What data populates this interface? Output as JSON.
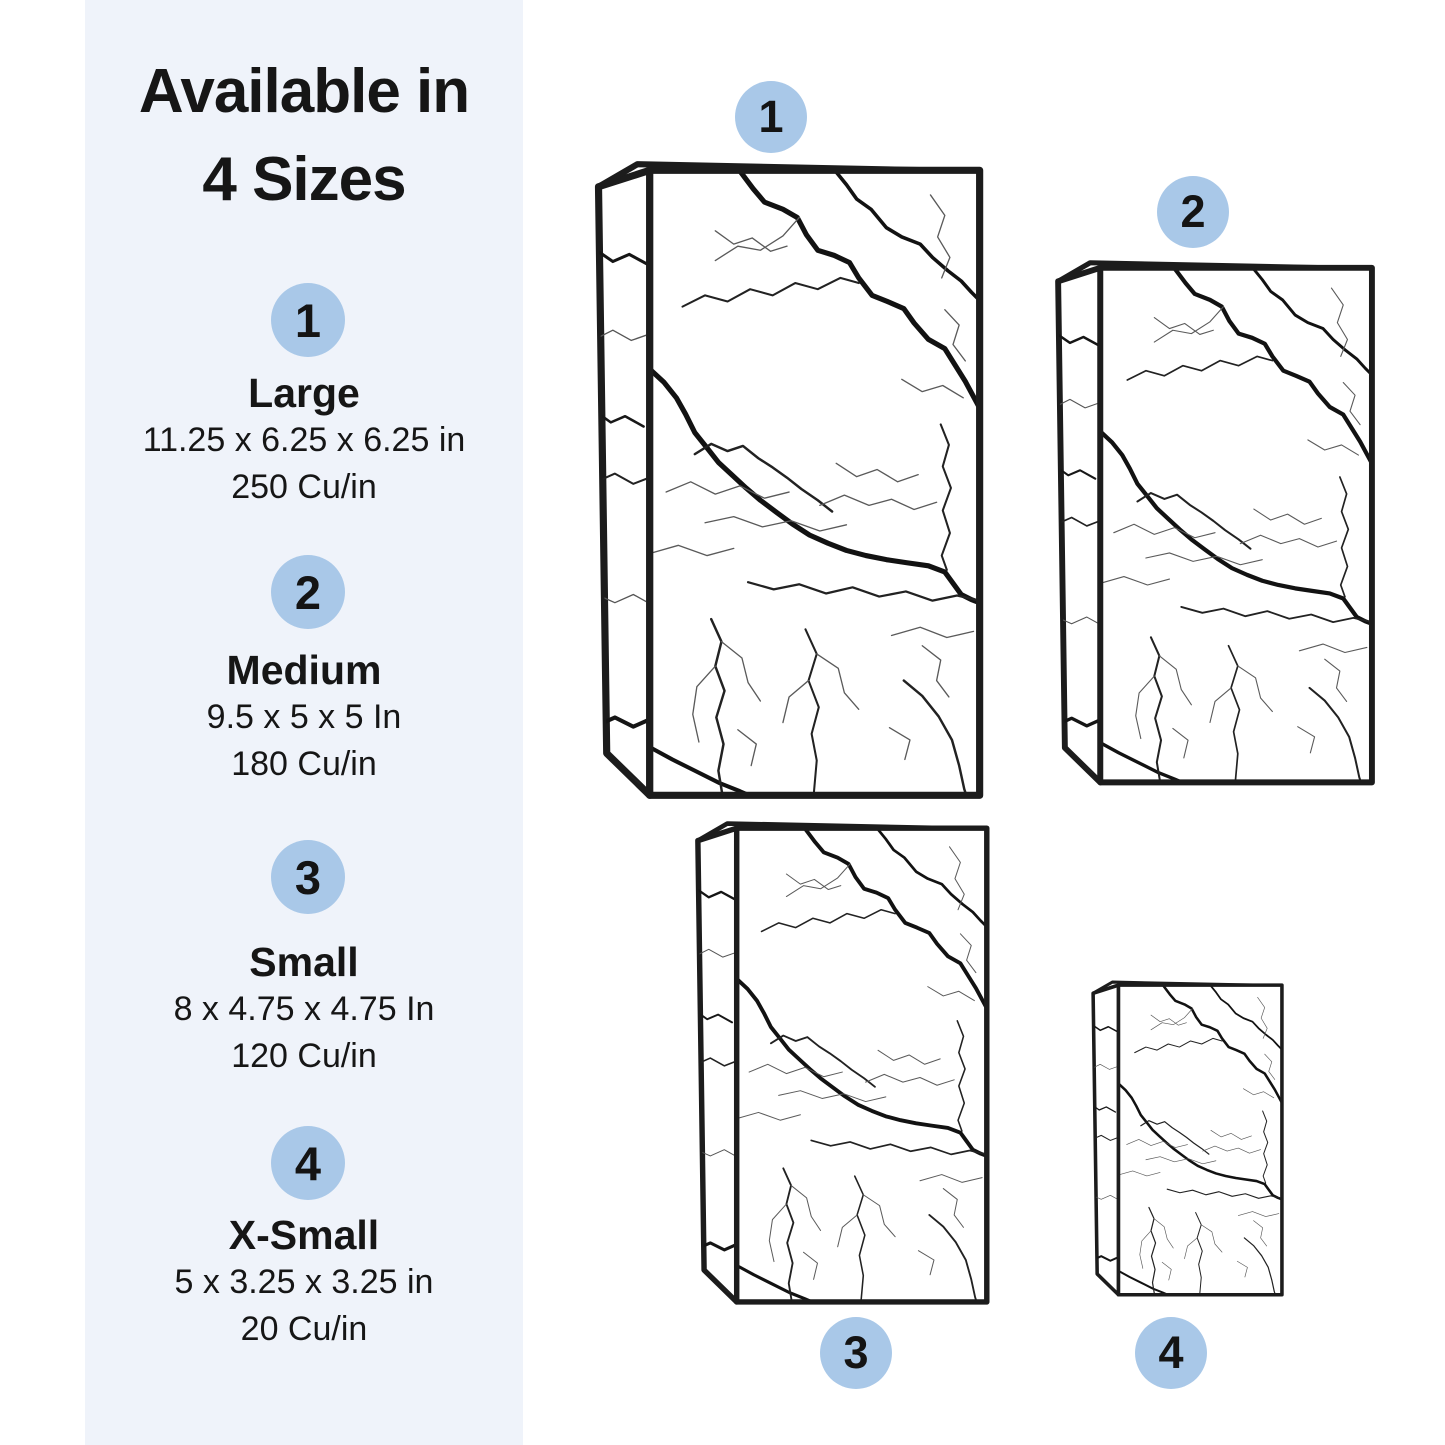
{
  "colors": {
    "page_bg": "#ffffff",
    "panel_bg": "#eff3fa",
    "badge_bg": "#a9c8e8",
    "ink": "#161616"
  },
  "sidebar": {
    "title_line1": "Available in",
    "title_line2": "4 Sizes",
    "sizes": [
      {
        "number": "1",
        "name": "Large",
        "dimensions": "11.25 x 6.25 x 6.25 in",
        "volume": "250 Cu/in"
      },
      {
        "number": "2",
        "name": "Medium",
        "dimensions": "9.5 x 5 x 5 In",
        "volume": "180 Cu/in"
      },
      {
        "number": "3",
        "name": "Small",
        "dimensions": "8 x 4.75 x 4.75 In",
        "volume": "120 Cu/in"
      },
      {
        "number": "4",
        "name": "X-Small",
        "dimensions": "5 x 3.25 x 3.25 in",
        "volume": "20 Cu/in"
      }
    ]
  },
  "diagram": {
    "boxes": [
      {
        "number": "1",
        "size_name": "Large"
      },
      {
        "number": "2",
        "size_name": "Medium"
      },
      {
        "number": "3",
        "size_name": "Small"
      },
      {
        "number": "4",
        "size_name": "X-Small"
      }
    ]
  }
}
